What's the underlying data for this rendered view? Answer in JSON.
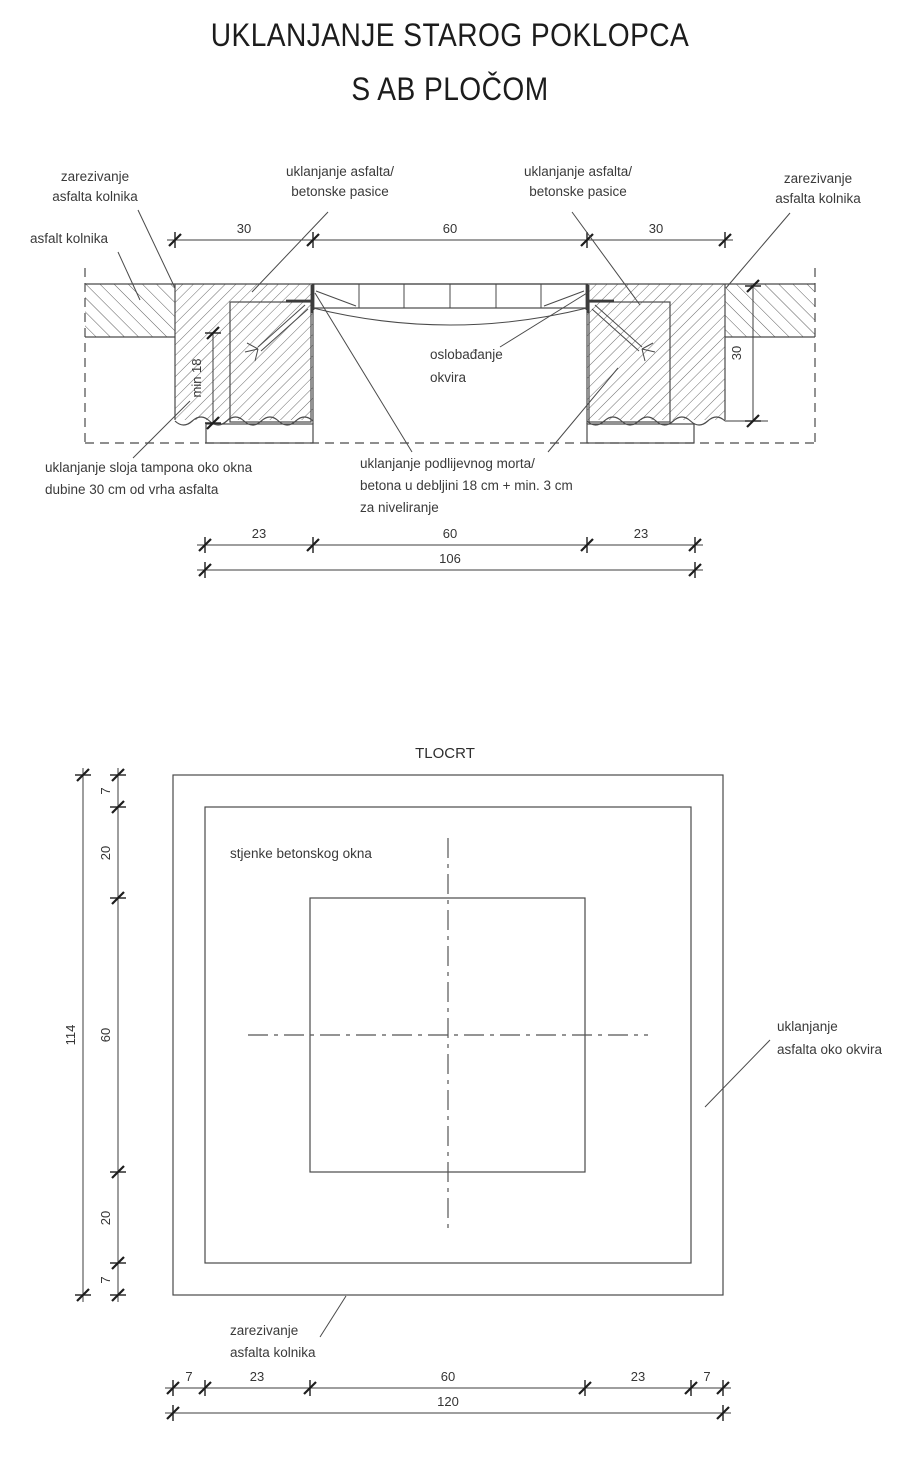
{
  "title": {
    "line1": "UKLANJANJE STAROG POKLOPCA",
    "line2": "S AB PLOČOM"
  },
  "section": {
    "labels": {
      "zarezivanje_left": {
        "l1": "zarezivanje",
        "l2": "asfalta kolnika"
      },
      "asfalt": "asfalt kolnika",
      "pasica_left": {
        "l1": "uklanjanje asfalta/",
        "l2": "betonske pasice"
      },
      "pasica_right": {
        "l1": "uklanjanje asfalta/",
        "l2": "betonske pasice"
      },
      "zarezivanje_right": {
        "l1": "zarezivanje",
        "l2": "asfalta kolnika"
      },
      "oslobadanje": {
        "l1": "oslobađanje",
        "l2": "okvira"
      },
      "tampon": {
        "l1": "uklanjanje sloja tampona oko okna",
        "l2": "dubine 30 cm od vrha asfalta"
      },
      "mort": {
        "l1": "uklanjanje podlijevnog morta/",
        "l2": "betona u debljini 18 cm + min. 3 cm",
        "l3": "za niveliranje"
      }
    },
    "dims": {
      "top_left": "30",
      "top_mid": "60",
      "top_right": "30",
      "min18": "min 18",
      "depth": "30",
      "bot_left": "23",
      "bot_mid": "60",
      "bot_right": "23",
      "total": "106"
    }
  },
  "plan": {
    "title": "TLOCRT",
    "labels": {
      "stjenke": "stjenke betonskog okna",
      "asfalt_okvir": {
        "l1": "uklanjanje",
        "l2": "asfalta oko okvira"
      },
      "zarezivanje": {
        "l1": "zarezivanje",
        "l2": "asfalta kolnika"
      }
    },
    "dims": {
      "v_total": "114",
      "v1": "7",
      "v2": "20",
      "v3": "60",
      "v4": "20",
      "v5": "7",
      "h_total": "120",
      "h1": "7",
      "h2": "23",
      "h3": "60",
      "h4": "23",
      "h5": "7"
    }
  },
  "colors": {
    "line": "#4a4a4a",
    "text": "#3a3a3a",
    "title": "#1c1c1c",
    "background": "#ffffff"
  }
}
